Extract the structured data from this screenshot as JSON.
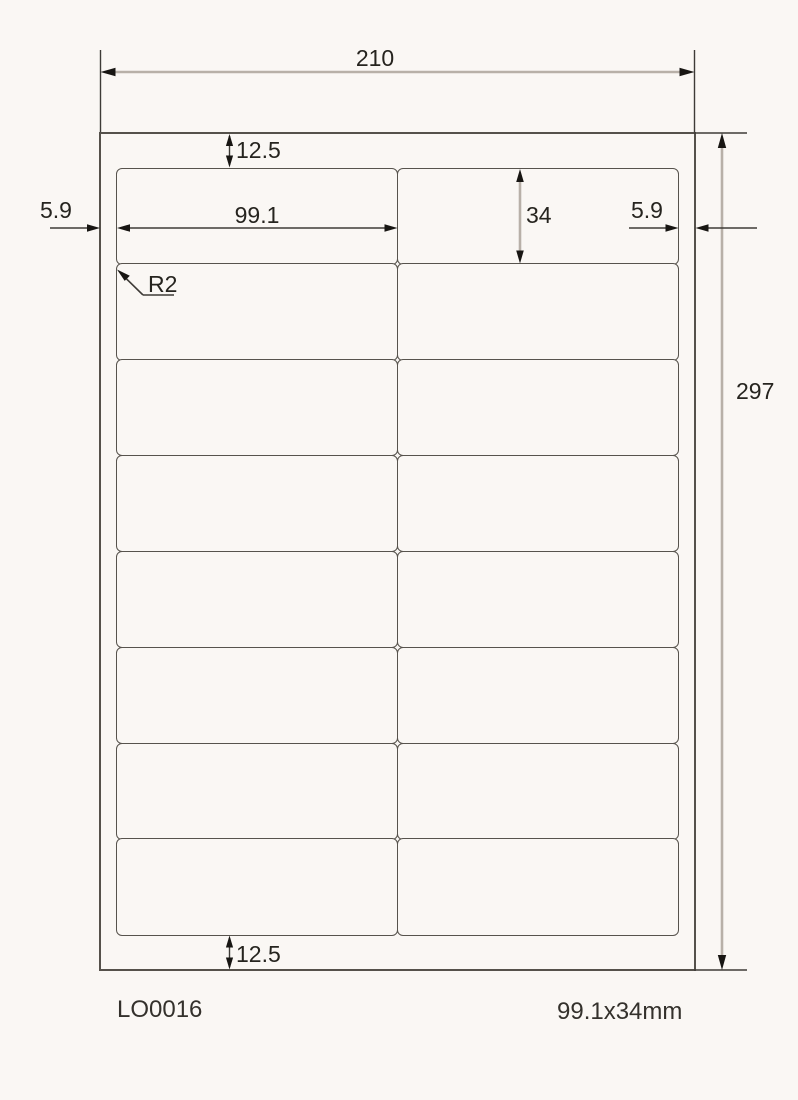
{
  "drawing": {
    "product_code": "LO0016",
    "label_size": "99.1x34mm",
    "dimensions": {
      "sheet_width": "210",
      "sheet_height": "297",
      "top_margin": "12.5",
      "bottom_margin": "12.5",
      "left_margin": "5.9",
      "right_margin": "5.9",
      "label_width": "99.1",
      "label_height": "34",
      "corner_radius": "R2"
    },
    "sheet": {
      "grid": {
        "rows": 8,
        "cols": 2
      }
    },
    "colors": {
      "background": "#faf7f4",
      "outline": "#55514b",
      "dim_line_light": "#b8b0a8",
      "dim_line_dark": "#3e3b37",
      "arrowhead": "#181613",
      "text": "#26241f"
    }
  }
}
